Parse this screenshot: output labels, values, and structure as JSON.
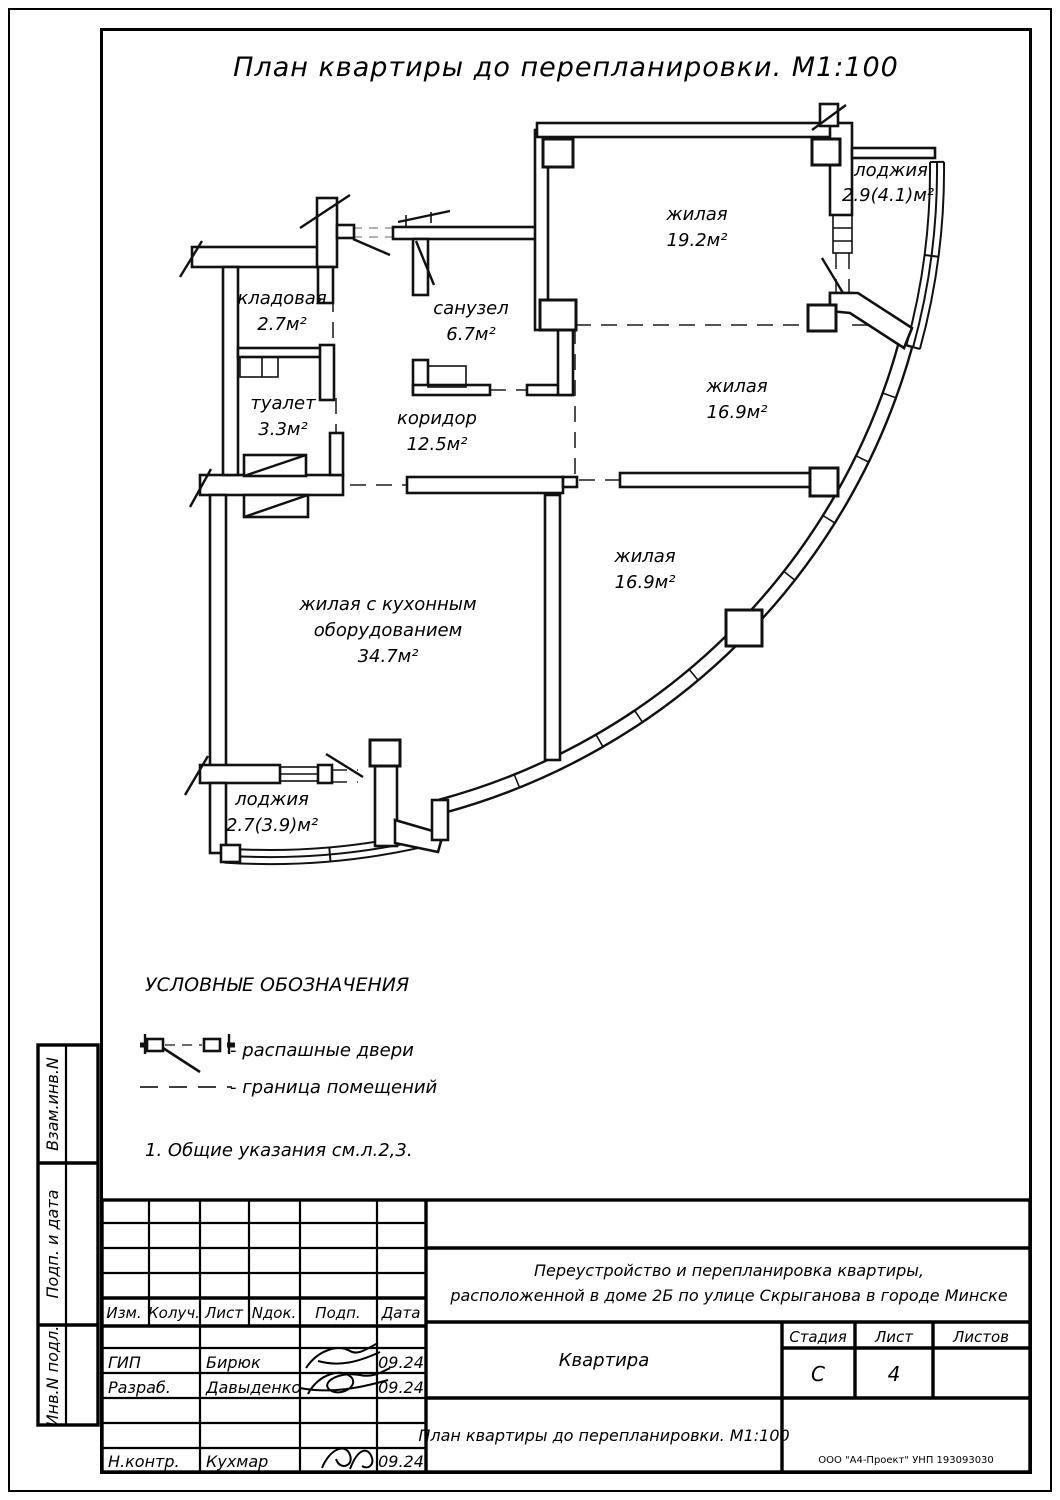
{
  "page_title": "План квартиры до перепланировки. М1:100",
  "plan": {
    "rooms": [
      {
        "name": "жилая",
        "area": "19.2м²"
      },
      {
        "name": "лоджия",
        "area": "2.9(4.1)м²"
      },
      {
        "name": "жилая",
        "area": "16.9м²"
      },
      {
        "name": "жилая",
        "area": "16.9м²"
      },
      {
        "name": "санузел",
        "area": "6.7м²"
      },
      {
        "name": "кладовая",
        "area": "2.7м²"
      },
      {
        "name": "туалет",
        "area": "3.3м²"
      },
      {
        "name": "коридор",
        "area": "12.5м²"
      },
      {
        "name": "жилая с кухонным",
        "name_line2": "оборудованием",
        "area": "34.7м²"
      },
      {
        "name": "лоджия",
        "area": "2.7(3.9)м²"
      }
    ]
  },
  "legend": {
    "heading": "УСЛОВНЫЕ ОБОЗНАЧЕНИЯ",
    "items": [
      {
        "label": "-  распашные двери"
      },
      {
        "label": "-  граница помещений"
      }
    ],
    "note": "1.  Общие указания см.л.2,3."
  },
  "side_stamp": {
    "labels": [
      "Взам.инв.N",
      "Подп. и дата",
      "Инв.N подл."
    ]
  },
  "title_block": {
    "columns": [
      "Изм.",
      "Колуч.",
      "Лист",
      "Nдок.",
      "Подп.",
      "Дата"
    ],
    "staff": [
      {
        "role": "ГИП",
        "name": "Бирюк",
        "date": "09.24"
      },
      {
        "role": "Разраб.",
        "name": "Давыденко",
        "date": "09.24"
      },
      {
        "role": "Н.контр.",
        "name": "Кухмар",
        "date": "09.24"
      }
    ],
    "project_line1": "Переустройство и перепланировка квартиры,",
    "project_line2": "расположенной в доме 2Б по улице Скрыганова в городе Минске",
    "object_name": "Квартира",
    "stage_label": "Стадия",
    "sheet_label": "Лист",
    "sheets_label": "Листов",
    "stage": "С",
    "sheet": "4",
    "sheets_total": "",
    "doc_title": "План квартиры до перепланировки. М1:100",
    "company": "ООО \"А4-Проект\" УНП 193093030"
  }
}
